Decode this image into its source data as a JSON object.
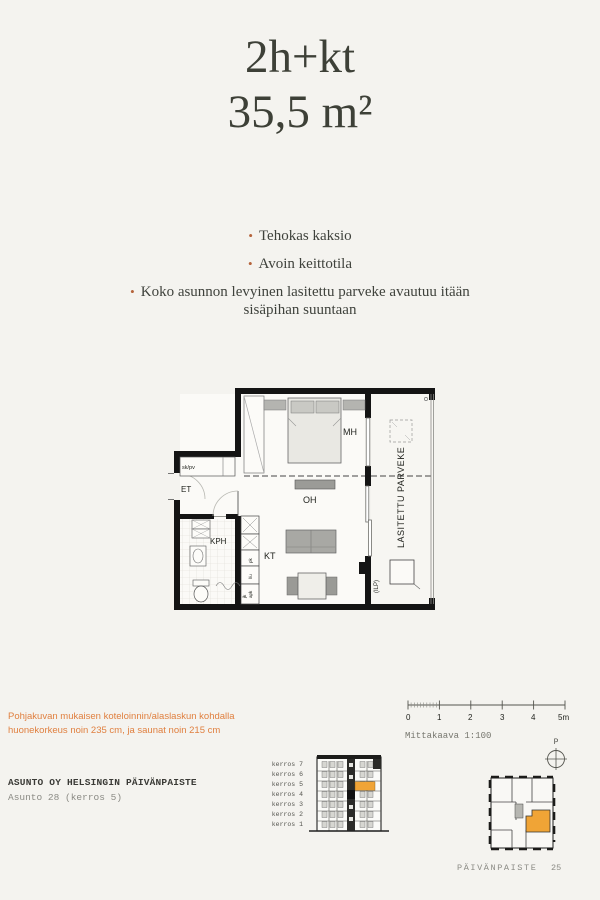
{
  "header": {
    "type_label": "2h+kt",
    "area_label": "35,5 m²"
  },
  "features": {
    "items": [
      "Tehokas kaksio",
      "Avoin keittotila",
      "Koko asunnon levyinen lasitettu parveke avautuu itään sisäpihan suuntaan"
    ]
  },
  "floorplan": {
    "rooms": {
      "mh": "MH",
      "oh": "OH",
      "kt": "KT",
      "kph": "KPH",
      "et": "ET",
      "closet": "sk/pv",
      "balcony": "LASITETTU PARVEKE",
      "ilp": "(ILP)"
    },
    "kitchen_labels": {
      "a": "pk",
      "b": "l/u",
      "c": "apk",
      "d": "jk"
    }
  },
  "note": {
    "text": "Pohjakuvan mukaisen koteloinnin/alaslaskun kohdalla huonekorkeus noin 235 cm, ja saunat noin 215 cm"
  },
  "project": {
    "name": "ASUNTO OY HELSINGIN PÄIVÄNPAISTE",
    "apartment": "Asunto 28 (kerros 5)"
  },
  "scalebar": {
    "labels": [
      "0",
      "1",
      "2",
      "3",
      "4",
      "5m"
    ],
    "caption": "Mittakaava 1:100"
  },
  "elevation": {
    "floors": [
      "kerros 7",
      "kerros 6",
      "kerros 5",
      "kerros 4",
      "kerros 3",
      "kerros 2",
      "kerros 1"
    ],
    "highlighted_floor": "kerros 5",
    "highlight_color": "#f0a436"
  },
  "compass": {
    "label": "P"
  },
  "footer": {
    "project": "PÄIVÄNPAISTE",
    "page_number": "25"
  }
}
